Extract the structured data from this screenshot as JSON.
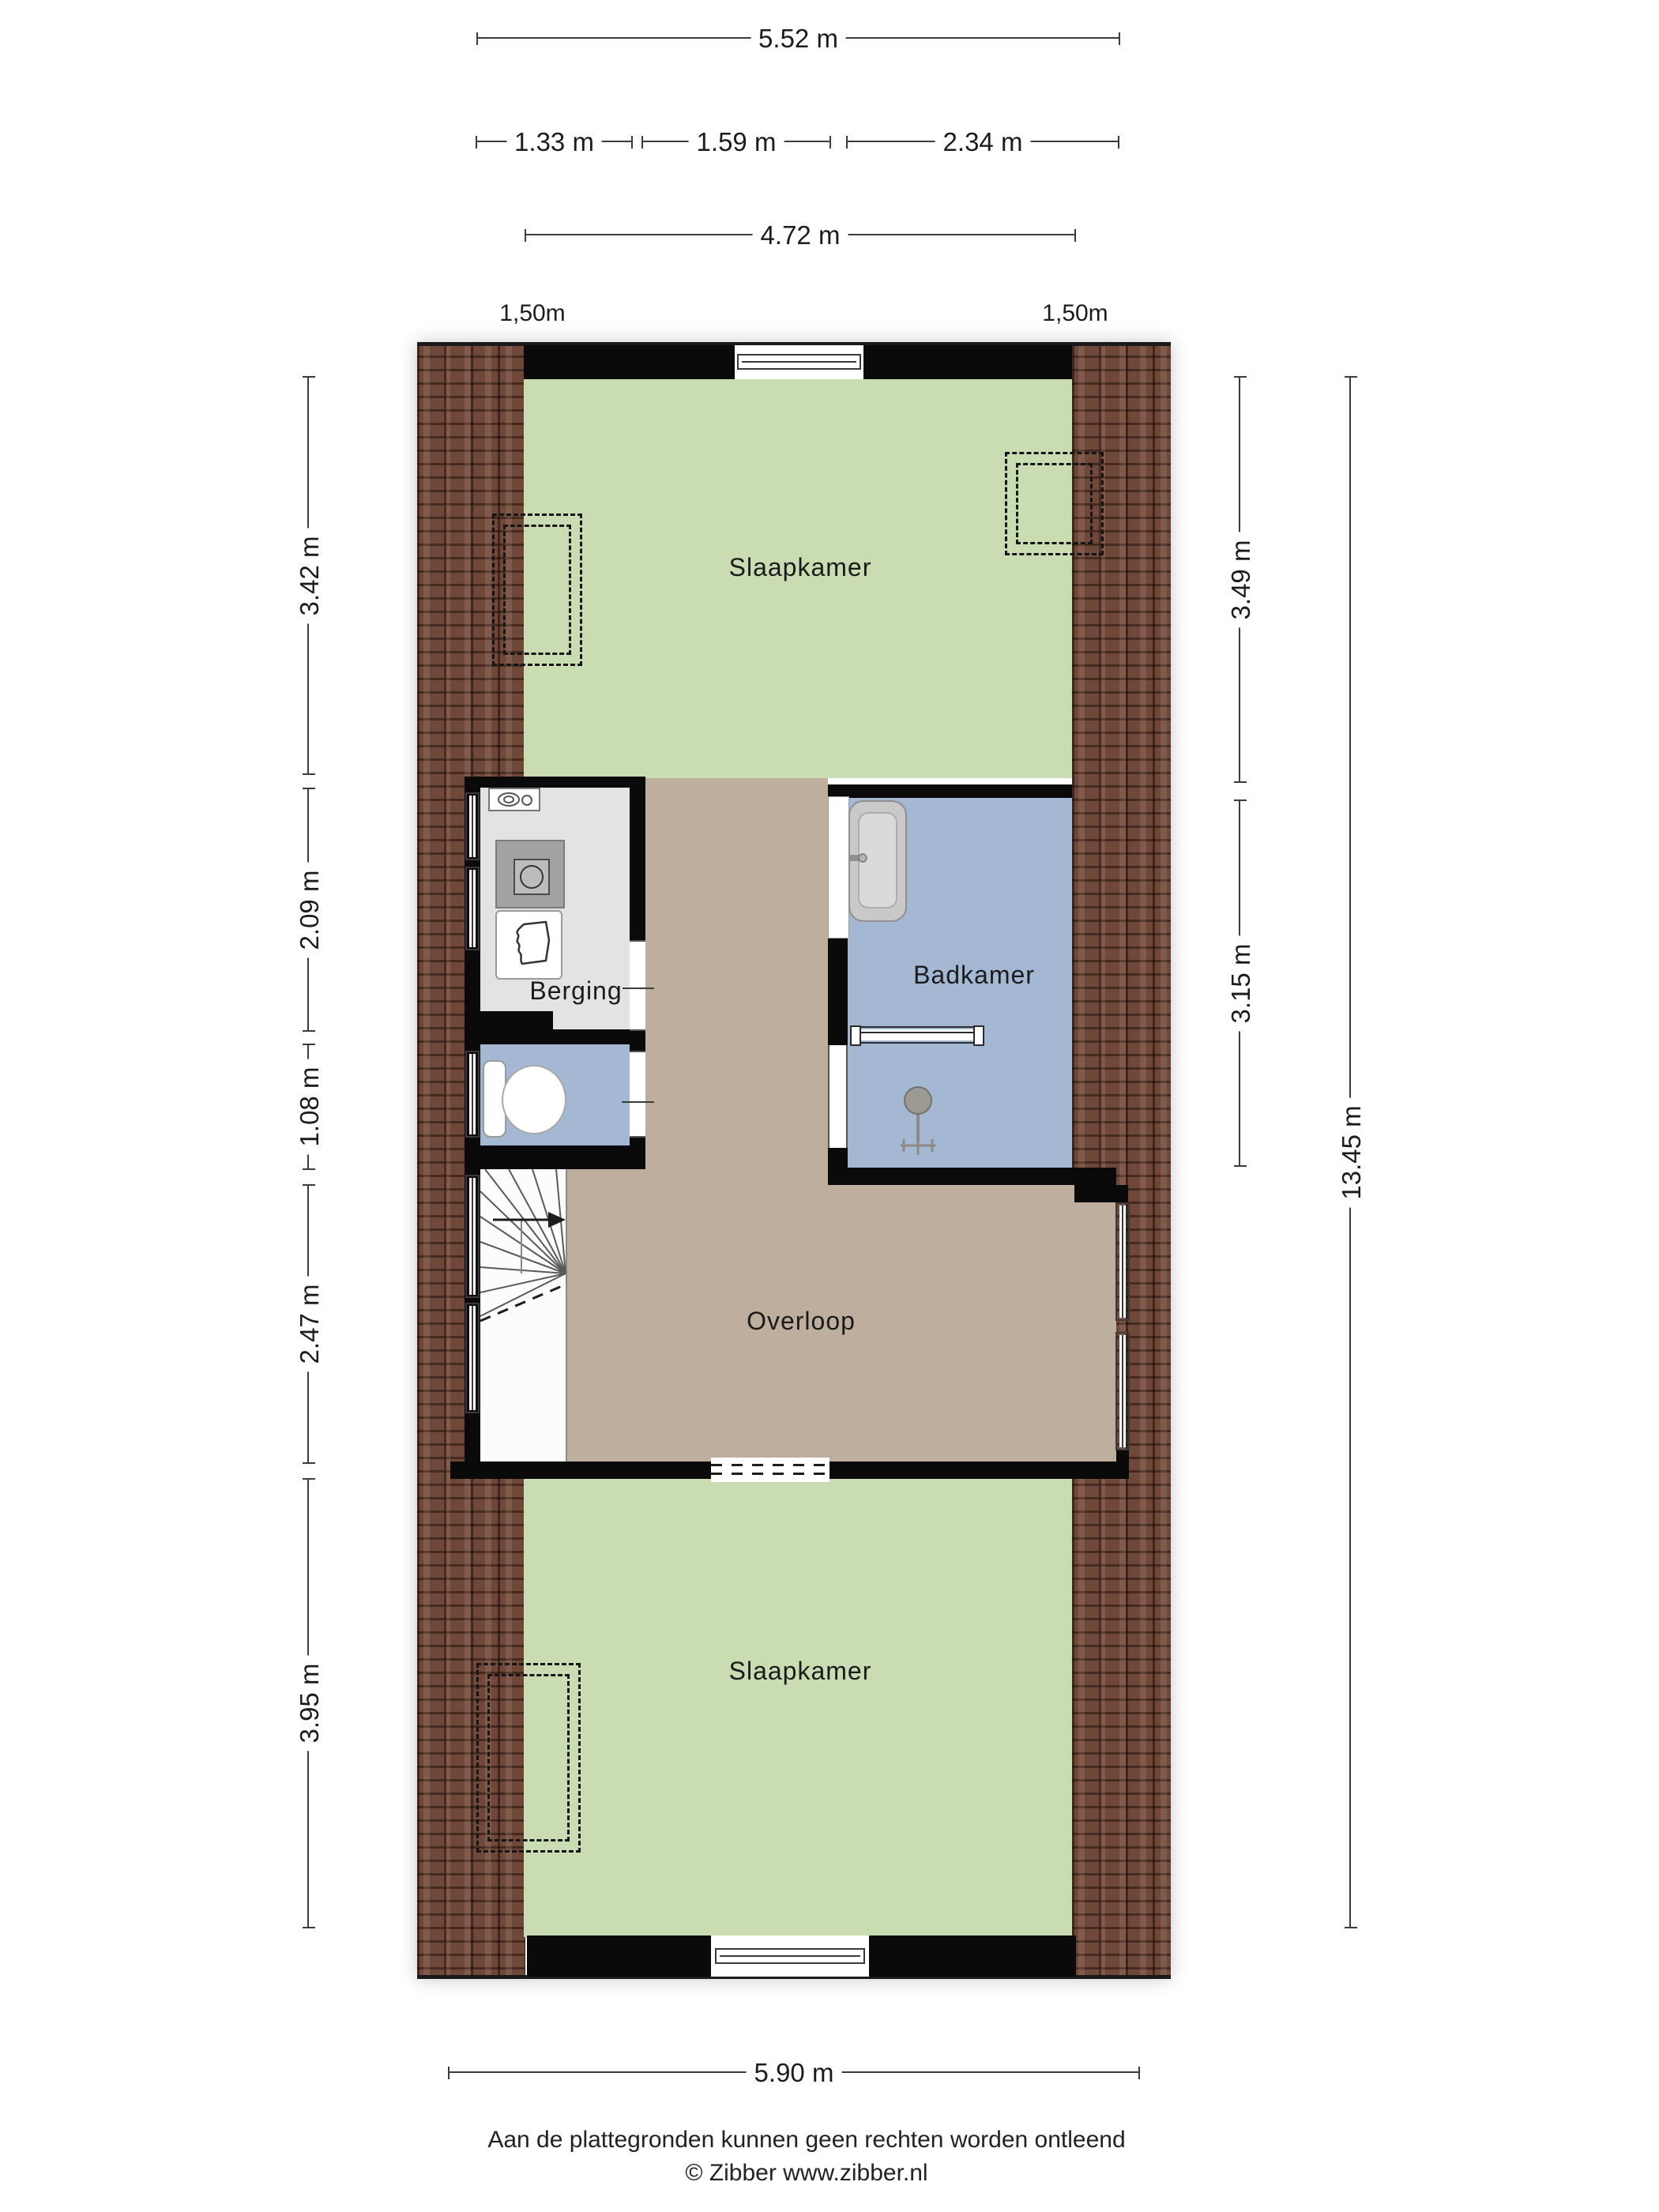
{
  "title": "Plattegrond verdieping",
  "dimensions": {
    "top_total": {
      "label": "5.52 m"
    },
    "top_segments": [
      {
        "label": "1.33 m"
      },
      {
        "label": "1.59 m"
      },
      {
        "label": "2.34 m"
      }
    ],
    "top_inner": {
      "label": "4.72 m"
    },
    "headroom_labels": [
      {
        "label": "1,50m"
      },
      {
        "label": "1,50m"
      }
    ],
    "left": [
      {
        "label": "3.42 m"
      },
      {
        "label": "2.09 m"
      },
      {
        "label": "1.08 m"
      },
      {
        "label": "2.47 m"
      },
      {
        "label": "3.95 m"
      }
    ],
    "right": [
      {
        "label": "3.49 m"
      },
      {
        "label": "3.15 m"
      }
    ],
    "right_total": {
      "label": "13.45 m"
    },
    "bottom": {
      "label": "5.90 m"
    }
  },
  "rooms": {
    "bedroom_top": {
      "label": "Slaapkamer"
    },
    "berging": {
      "label": "Berging"
    },
    "badkamer": {
      "label": "Badkamer"
    },
    "overloop": {
      "label": "Overloop"
    },
    "bedroom_bottom": {
      "label": "Slaapkamer"
    }
  },
  "fixtures": [
    "vent-unit",
    "washing-machine",
    "laundry-basket",
    "toilet",
    "sink",
    "radiator",
    "shower",
    "stairs"
  ],
  "footer": {
    "disclaimer": "Aan de plattegronden kunnen geen rechten worden ontleend",
    "copyright": "© Zibber www.zibber.nl"
  },
  "colors": {
    "room_green": "#c9dcb2",
    "room_blue": "#a4b8d3",
    "room_tan": "#bdae9e",
    "room_gray": "#e3e3e3",
    "wall": "#0a0a0a",
    "roof_brick": "#6f4839",
    "dimension": "#3c3c3c"
  }
}
